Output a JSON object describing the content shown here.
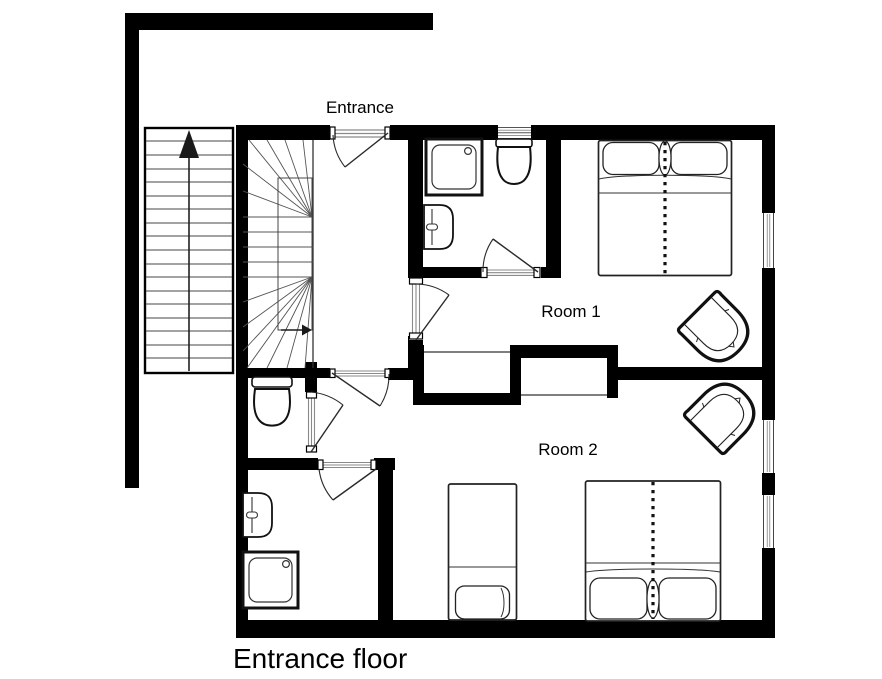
{
  "floor_plan": {
    "floor_label": "Entrance floor",
    "room_labels": {
      "entrance": "Entrance",
      "room1": "Room 1",
      "room2": "Room 2"
    },
    "colors": {
      "wall": "#000000",
      "fixture_line": "#222222",
      "hatch_line": "#8a8a8a",
      "background": "#ffffff"
    },
    "areas": [
      {
        "id": "entrance-hall",
        "fixtures": [
          "interior-winder-staircase",
          "entrance-door"
        ]
      },
      {
        "id": "room-1",
        "fixtures": [
          "double-bed",
          "armchair",
          "closet",
          "window"
        ]
      },
      {
        "id": "room-2",
        "fixtures": [
          "double-bed",
          "single-bed",
          "armchair",
          "closet",
          "window",
          "window"
        ]
      },
      {
        "id": "bathroom-upper",
        "fixtures": [
          "shower",
          "toilet",
          "washbasin",
          "window"
        ]
      },
      {
        "id": "wc",
        "fixtures": [
          "toilet"
        ]
      },
      {
        "id": "bathroom-lower",
        "fixtures": [
          "shower",
          "washbasin"
        ]
      },
      {
        "id": "exterior",
        "fixtures": [
          "exterior-staircase",
          "up-arrow"
        ]
      }
    ]
  }
}
